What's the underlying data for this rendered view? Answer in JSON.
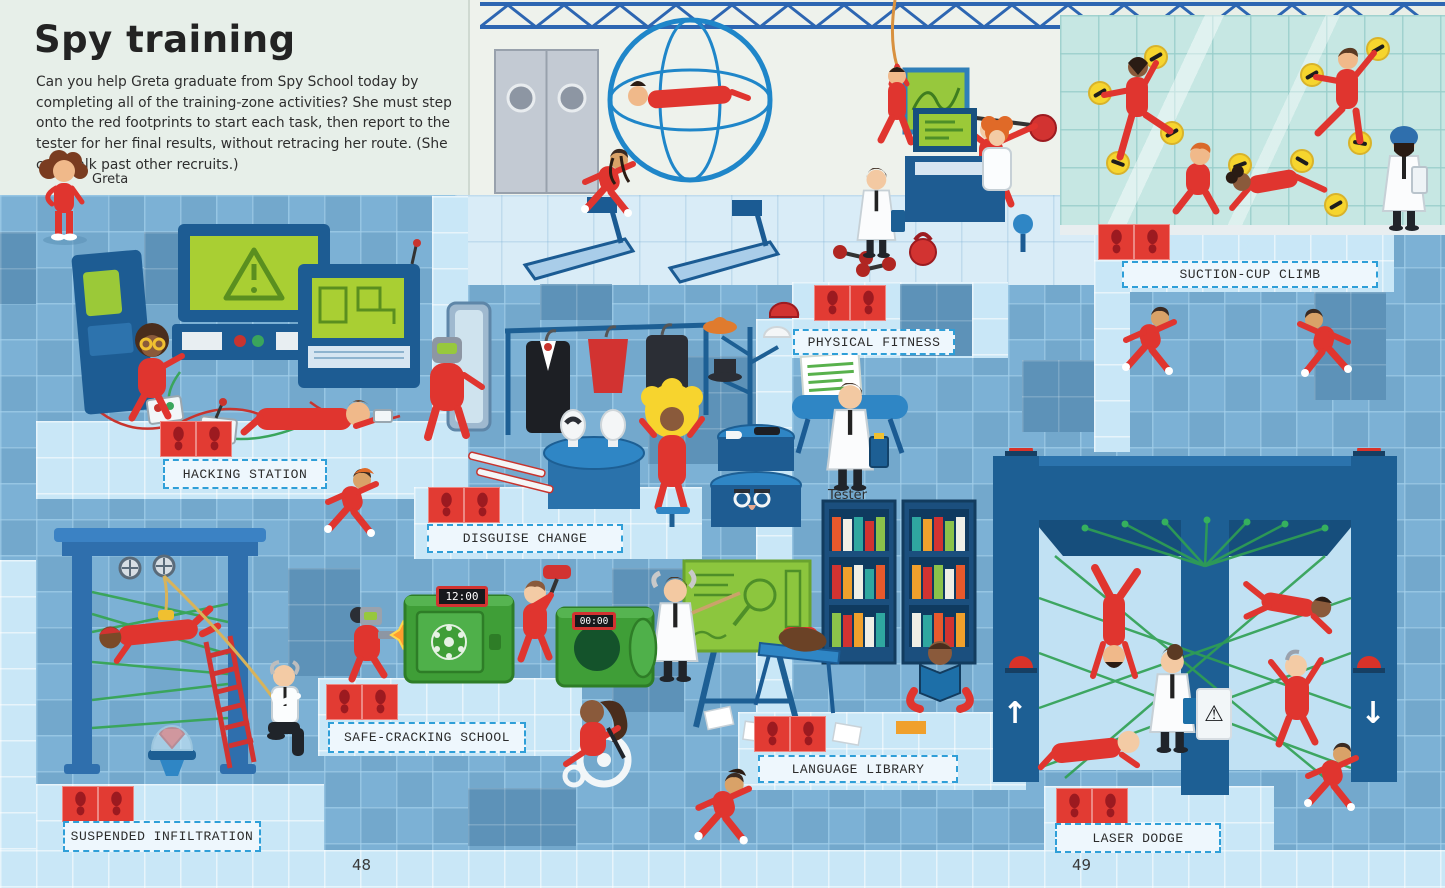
{
  "page": {
    "title": "Spy training",
    "intro": "Can you help Greta graduate from Spy School today by completing all of the training-zone activities? She must step onto the red footprints to start each task, then report to the tester for her final results, without retracing her route. (She can walk past other recruits.)",
    "page_number_left": "48",
    "page_number_right": "49"
  },
  "characters": {
    "greta_label": "Greta",
    "tester_label": "Tester"
  },
  "stations": [
    {
      "label": "HACKING STATION"
    },
    {
      "label": "DISGUISE CHANGE"
    },
    {
      "label": "PHYSICAL FITNESS"
    },
    {
      "label": "SUCTION-CUP CLIMB"
    },
    {
      "label": "SAFE-CRACKING SCHOOL"
    },
    {
      "label": "SUSPENDED INFILTRATION"
    },
    {
      "label": "LANGUAGE LIBRARY"
    },
    {
      "label": "LASER DODGE"
    }
  ],
  "props": {
    "safe_timer_running": "12:00",
    "safe_timer_done": "00:00"
  },
  "icons": {
    "up_arrow": "↑",
    "down_arrow": "↓",
    "warning": "⚠",
    "footprint": "shoe-print (drawn as SVG)"
  },
  "colors": {
    "recruit_red": "#e0352f",
    "footprint_tile_red": "#e23b33",
    "floor_mid_blue": "#7cb1d5",
    "floor_path_blue": "#c9e7f7",
    "floor_dark_blue": "#5d92b8",
    "label_border_blue": "#2f9fd8",
    "laser_green": "#2fa052",
    "safe_green": "#3f9e37",
    "suction_cup_yellow": "#f6d52e",
    "wall_mint": "#e9efe8"
  }
}
